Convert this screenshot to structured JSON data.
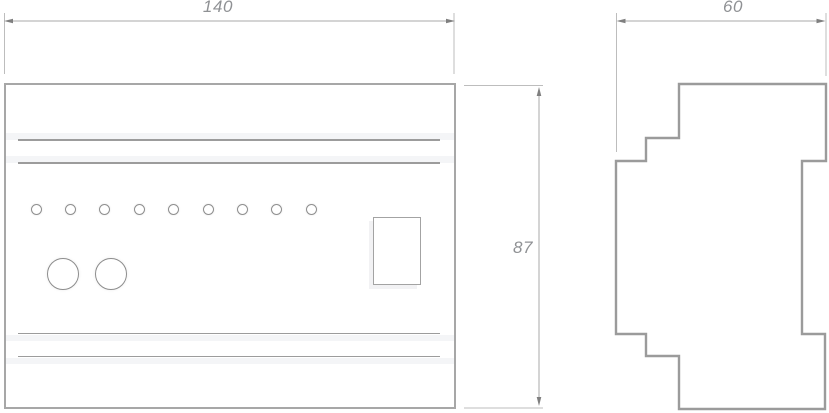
{
  "dimensions": {
    "front_width": "140",
    "front_height": "87",
    "side_depth": "60"
  },
  "front_view": {
    "led_indicator_count": 9,
    "push_button_count": 2,
    "display_window_count": 1,
    "groove_count": 4
  },
  "side_view": {
    "profile": "stepped DIN-rail module cross-section"
  },
  "colors": {
    "background": "#ffffff",
    "outline_gray": "#a7a7a7",
    "profile_gray": "#9b9b9b",
    "groove_line_gray": "#9c9c9c",
    "groove_highlight": "#f4f5f7",
    "dimension_line_gray": "#aaaaaa",
    "arrow_gray": "#7f7f7f",
    "label_text_gray": "#8f9194"
  }
}
